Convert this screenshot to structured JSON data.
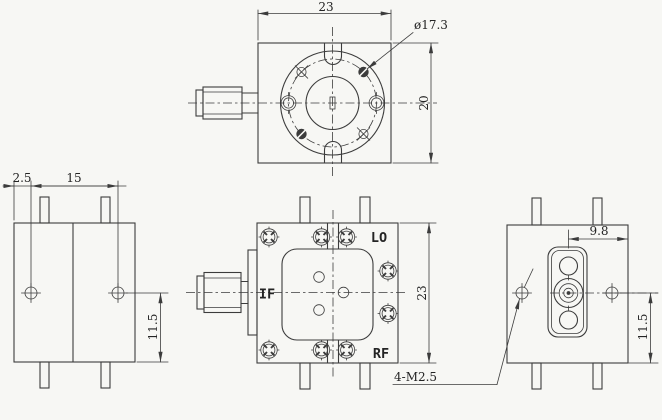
{
  "colors": {
    "bg": "#f7f7f4",
    "line": "#3c3c3c"
  },
  "drawing": {
    "dimensions": {
      "top_width": "23",
      "flange_diameter": "ø17.3",
      "top_depth": "20",
      "pin_offset": "2.5",
      "pin_pitch": "15",
      "left_height": "11.5",
      "front_height": "23",
      "connector_offset": "9.8",
      "right_height": "11.5",
      "thread_note": "4-M2.5"
    },
    "ports": {
      "lo": "LO",
      "if": "IF",
      "rf": "RF"
    }
  }
}
